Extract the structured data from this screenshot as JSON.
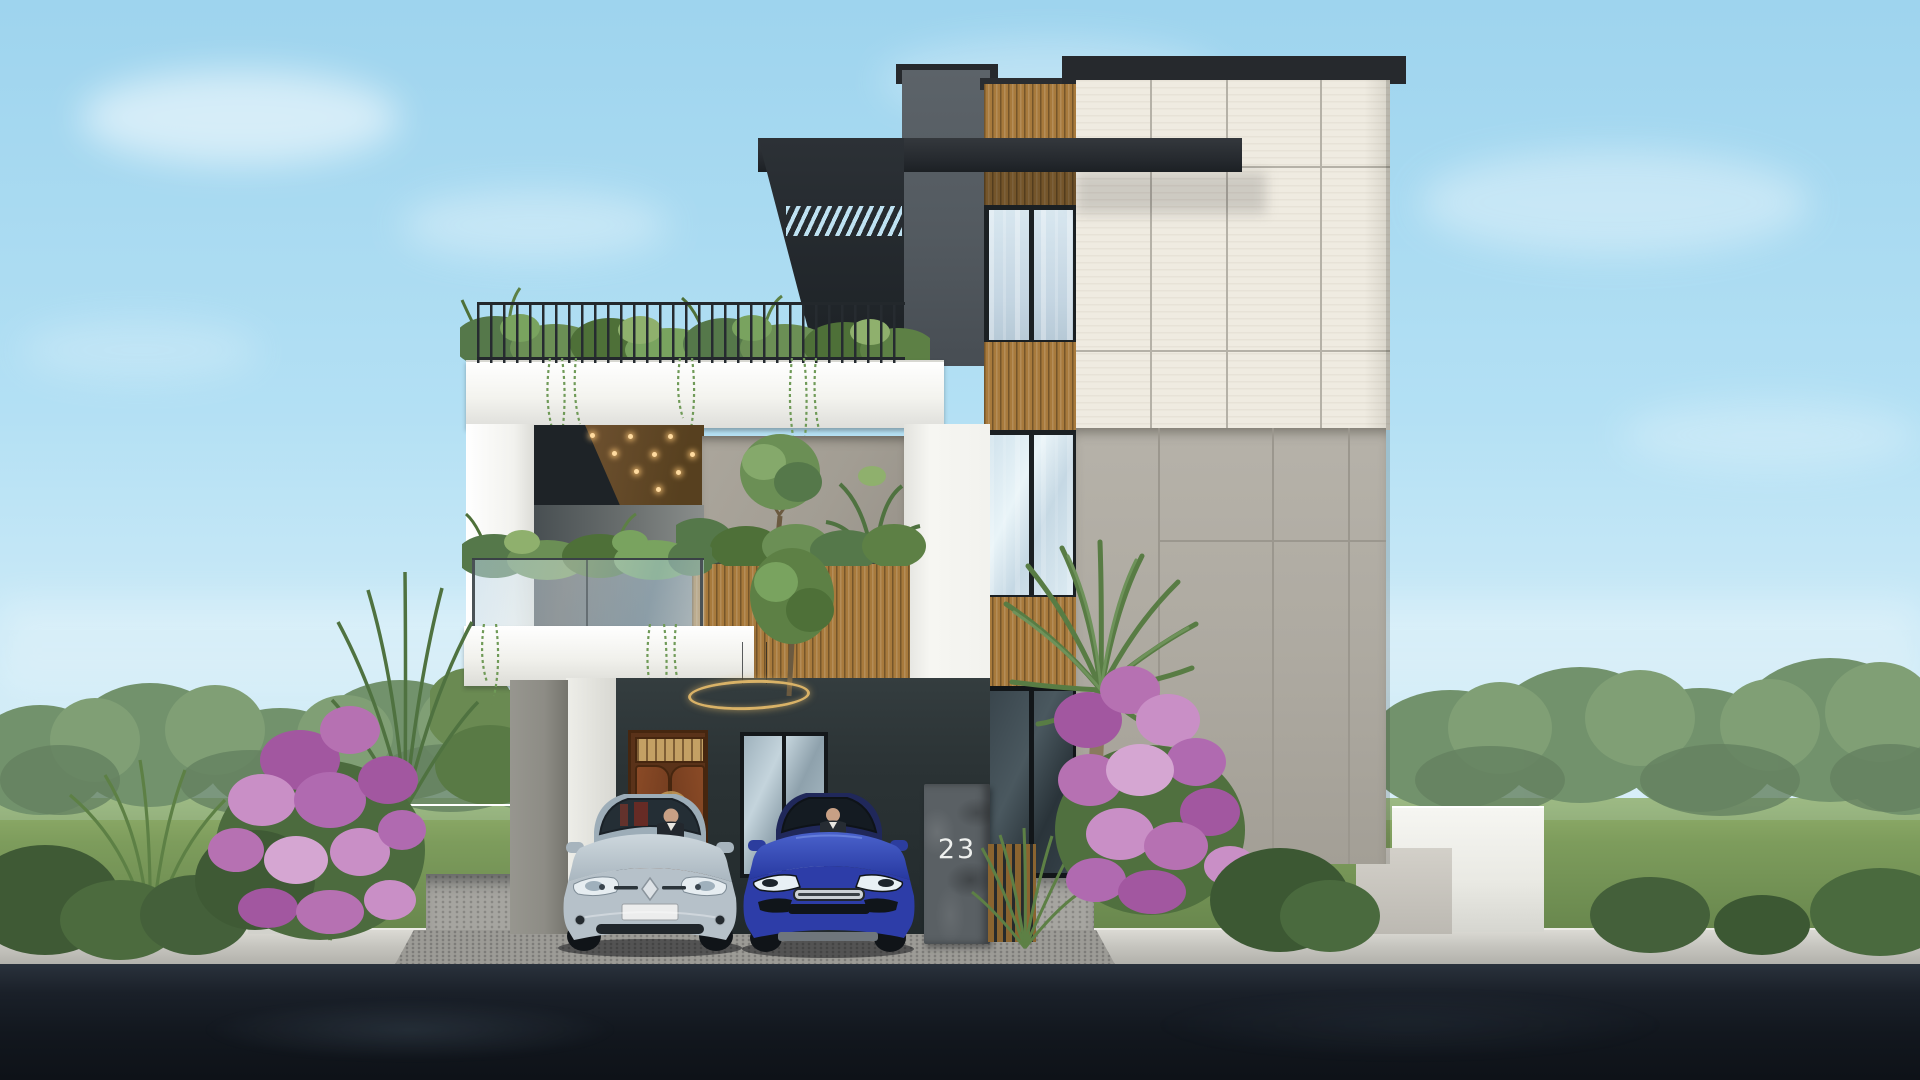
{
  "scene": {
    "title": "Modern three-storey villa exterior - daytime 3D architectural rendering",
    "house_number": "23",
    "time_of_day": "day",
    "objects": [
      "sky with soft clouds",
      "background tree line",
      "green lawn",
      "dark asphalt road",
      "paved sidewalk",
      "cobblestone driveway ramp",
      "three-storey modern villa",
      "rooftop terrace with black metal railing and planters",
      "cantilevered white slab with recessed timber soffit and downlights",
      "dark slatted pergola canopy",
      "glass-balustrade balcony with hanging plants",
      "timber slat planter wall",
      "round topiary tree",
      "concrete feature wall",
      "charcoal entry porch",
      "wooden double entry door",
      "glass sliding door",
      "gold ring pendant light",
      "vertical window strip with timber spandrels",
      "cream stone-panel tower",
      "exposed concrete side wall",
      "stone gate pillar with house number",
      "timber gate fence",
      "white compound walls",
      "silver hatchback car with driver",
      "blue hatchback car with driver",
      "date palm",
      "bougainvillea shrubs",
      "ornamental spiky plants and bushes"
    ]
  },
  "palette": {
    "sky_top": "#9ed4ee",
    "sky_horizon": "#e8f6fb",
    "grass": "#7d9c5c",
    "foliage": "#5f7f4f",
    "road_asphalt": "#161b22",
    "sidewalk": "#c7c6c0",
    "cobble": "#a3a29d",
    "wall_white": "#f5f5f1",
    "panel_cream": "#efebe1",
    "concrete_gray": "#b2aea5",
    "feature_wall_gray": "#a8a399",
    "tower_gray": "#565d63",
    "charcoal": "#2b3335",
    "canopy_dark": "#24282d",
    "wood_slat": "#a87a3c",
    "soffit_wood": "#6e5130",
    "door_wood": "#8a4a26",
    "glass_tint": "#cddee9",
    "railing_black": "#23282c",
    "stone_pillar": "#5a6064",
    "ring_light_gold": "#d9b267",
    "car_silver": "#b6c1c9",
    "car_blue": "#2d3da8",
    "flower_purple": "#b06ab0",
    "palm_green": "#5d7f48"
  }
}
